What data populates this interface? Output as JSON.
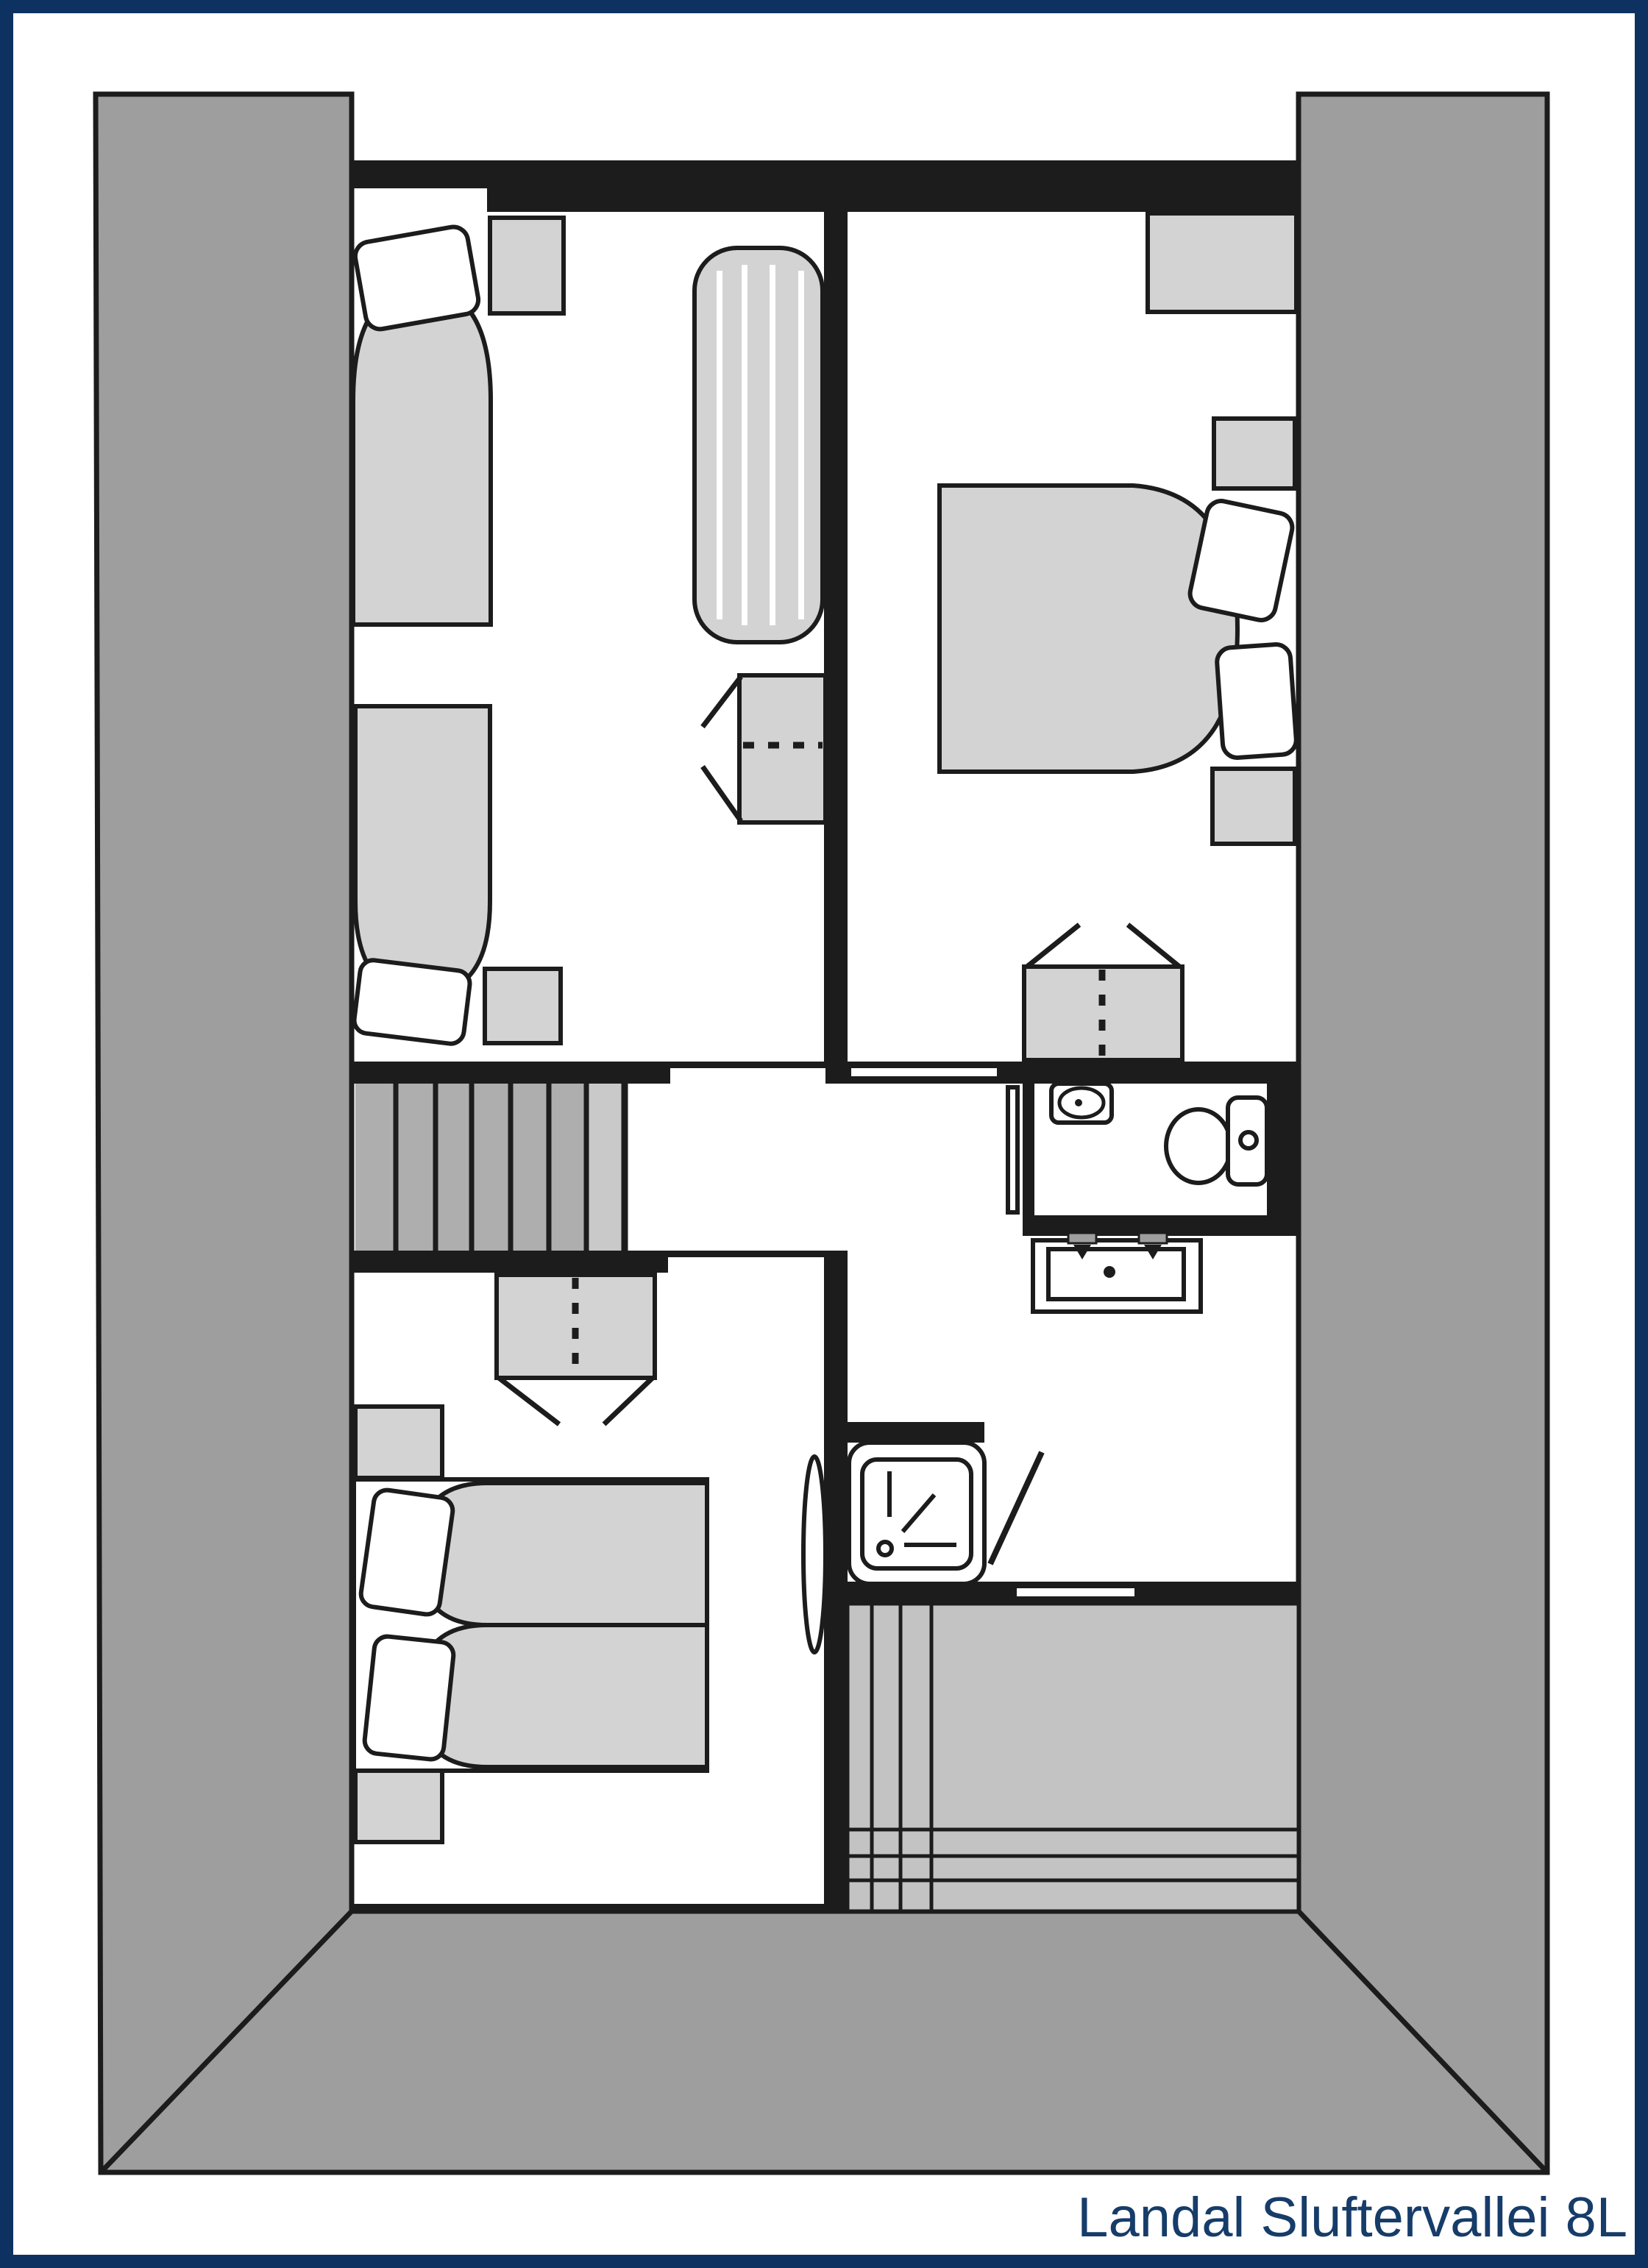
{
  "title": "Landal Sluftervallei 8L",
  "colors": {
    "frame_navy": "#0d3262",
    "title_navy": "#163c69",
    "wall_black": "#1c1c1c",
    "roof_gray": "#9e9e9e",
    "stair_gray": "#aeaeae",
    "stair_landing_gray": "#c9c9c9",
    "void_gray": "#c3c3c3",
    "furniture_gray": "#d3d3d3",
    "background": "#ffffff"
  },
  "legend": {
    "furniture_icons": [
      "single-bed-icon",
      "double-bed-icon",
      "air-mattress-icon",
      "pillow-icon",
      "nightstand-icon",
      "wardrobe-icon",
      "staircase-icon",
      "toilet-icon",
      "washbasin-icon",
      "vanity-sink-icon",
      "shower-icon",
      "door-leaf-icon",
      "roof-slope-icon"
    ]
  }
}
